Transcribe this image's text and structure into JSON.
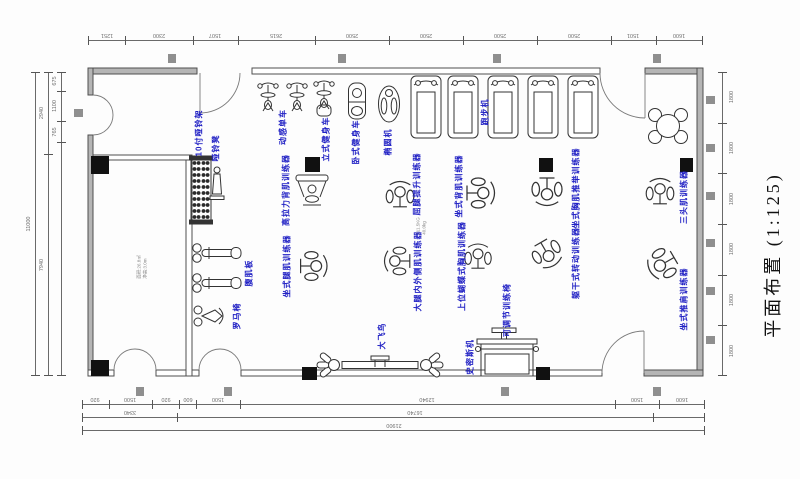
{
  "title": "平面布置 (1:125)",
  "scale": "1:125",
  "colors": {
    "label_blue": "#2121c4",
    "wall_grey": "#b5b5b5",
    "line_dark": "#3a3a3a",
    "column_black": "#111111",
    "marker_grey": "#8f8f8f",
    "dim_text_grey": "#6e6e6e"
  },
  "dims": {
    "top": [
      "1251",
      "2300",
      "1507",
      "2615",
      "2500",
      "2500",
      "2500",
      "2500",
      "1501",
      "1600"
    ],
    "bottom1": [
      "920",
      "1500",
      "920",
      "600",
      "1500",
      "12940",
      "1500",
      "1600"
    ],
    "bottom2": [
      "3340",
      "16740",
      ""
    ],
    "bottom3": [
      "21900"
    ],
    "left_outer": [
      "11000"
    ],
    "left_mid": [
      "2940",
      "7940"
    ],
    "left_inner": [
      "675",
      "1100",
      "765",
      ""
    ],
    "right": [
      "1800",
      "1800",
      "1800",
      "1800",
      "1800",
      "1800"
    ]
  },
  "equipment": [
    {
      "id": "dumbbell-rack",
      "label": "10付哑铃架"
    },
    {
      "id": "dumbbell-bench",
      "label": "哑铃凳"
    },
    {
      "id": "spinning-bike",
      "label": "动感单车"
    },
    {
      "id": "upright-bike",
      "label": "立式健身车"
    },
    {
      "id": "recumbent-bike",
      "label": "卧式健身车"
    },
    {
      "id": "elliptical",
      "label": "椭圆机"
    },
    {
      "id": "treadmill",
      "label": "跑步机"
    },
    {
      "id": "lat-pulldown",
      "label": "高拉力背肌训练器"
    },
    {
      "id": "leg-raise",
      "label": "屈腿提升训练器"
    },
    {
      "id": "seated-back",
      "label": "坐式背肌训练器"
    },
    {
      "id": "seated-chest-press",
      "label": "坐式胸肌推举训练器"
    },
    {
      "id": "seated-leg",
      "label": "坐式腿肌训练器"
    },
    {
      "id": "thigh-machine",
      "label": "大腿内外侧肌训练器"
    },
    {
      "id": "butterfly-machine",
      "label": "上位蝴蝶式胸肌训练器"
    },
    {
      "id": "torso-rotation",
      "label": "躯干式转动训练器"
    },
    {
      "id": "triceps-machine",
      "label": "三头肌训练器"
    },
    {
      "id": "shoulder-press",
      "label": "坐式推肩训练器"
    },
    {
      "id": "adjustable-bench",
      "label": "可调节训练椅"
    },
    {
      "id": "ab-board",
      "label": "腹肌板"
    },
    {
      "id": "roman-chair",
      "label": "罗马椅"
    },
    {
      "id": "cable-crossover",
      "label": "大飞鸟"
    },
    {
      "id": "smith-machine",
      "label": "史密斯机"
    }
  ],
  "notes": {
    "room_note": [
      "面积:26.8㎡",
      "净高:3.0m"
    ],
    "machine_note": [
      "211.5KG",
      "40.0kg"
    ]
  }
}
